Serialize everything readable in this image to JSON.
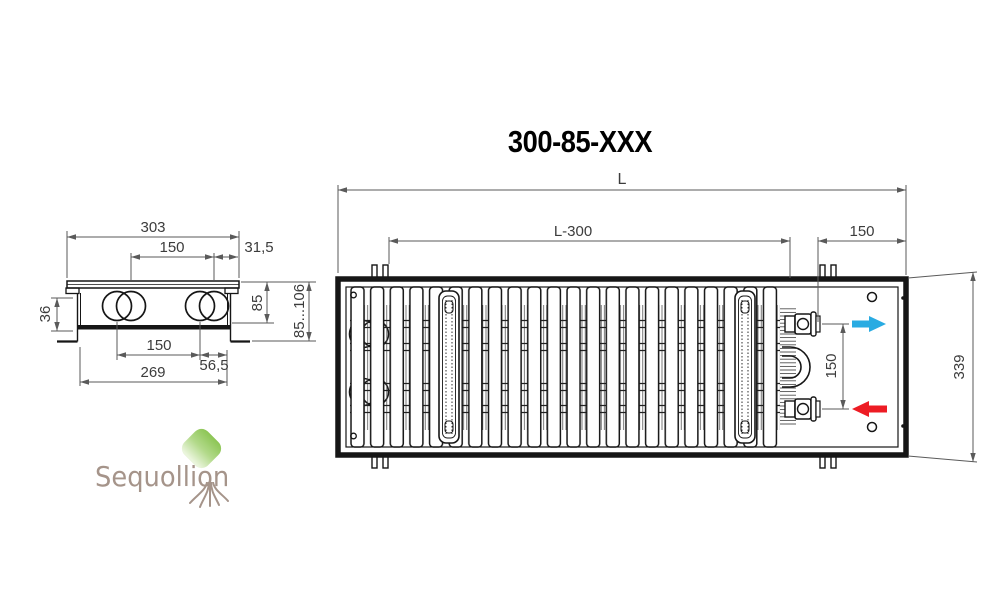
{
  "title": "300-85-XXX",
  "logo": {
    "text": "Sequollion"
  },
  "side_view": {
    "dims": {
      "top_width": "303",
      "pipe_spacing_top": "150",
      "top_edge_offset": "31,5",
      "inlet_height": "36",
      "body_height": "85",
      "install_height_range": "85...106",
      "pipe_spacing_bottom": "150",
      "bottom_edge_offset": "56,5",
      "bottom_width": "269"
    }
  },
  "top_view": {
    "dims": {
      "total_length": "L",
      "inner_length": "L-300",
      "end_offset": "150",
      "connection_spacing": "150",
      "width": "339"
    },
    "flow": {
      "supply_color": "#29abe2",
      "return_color": "#ed1c24"
    }
  }
}
